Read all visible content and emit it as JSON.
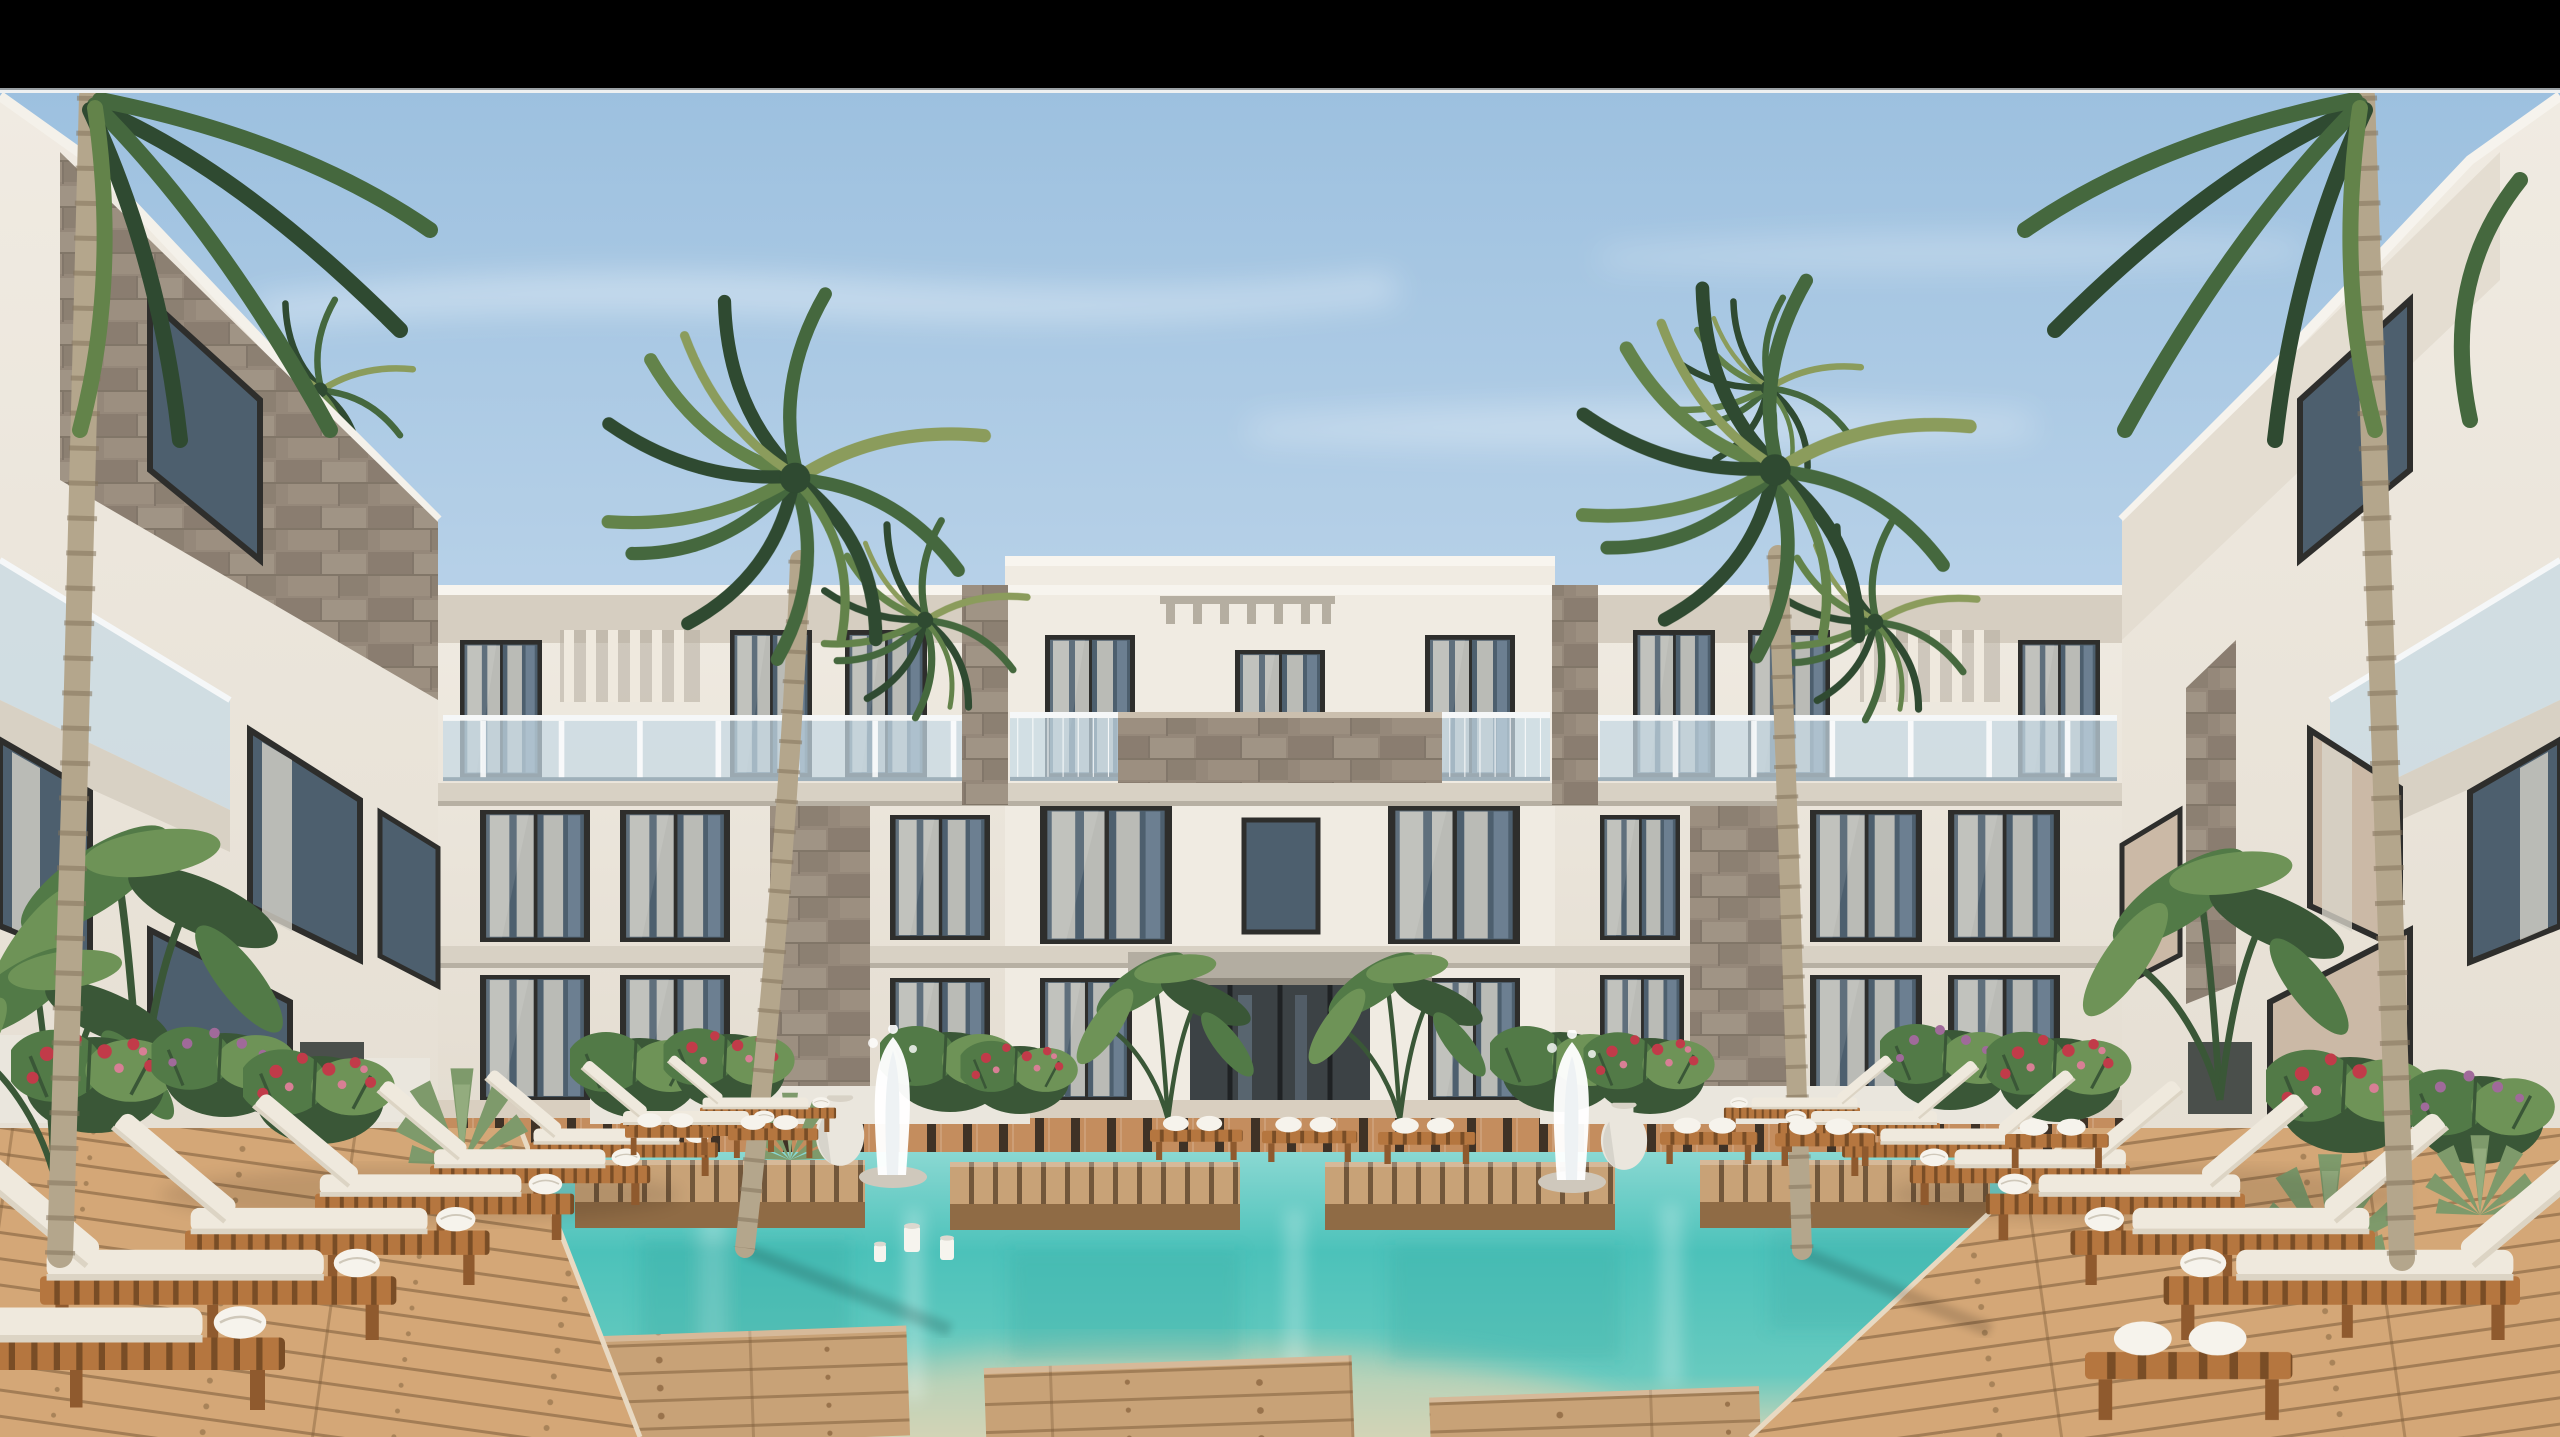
{
  "scene": {
    "kind": "architectural-render",
    "setting": "modern-resort-courtyard-with-pool",
    "letterbox": "black bar across top of frame",
    "buildings": {
      "center_building_floors": 3,
      "left_foreground_building": "stone-clad white wing",
      "right_foreground_building": "white wing with balconies",
      "features": [
        "glass balcony railings",
        "stone feature panels",
        "sheer curtains in windows",
        "entrance canopy",
        "pergola slats"
      ]
    },
    "vegetation": {
      "courtyard_palms": 2,
      "edge_palms": 2,
      "rooftop_palms": 4,
      "banana_plants": 4,
      "agaves": 4,
      "flower_bushes_red": 6,
      "flower_bushes_purple": 3
    },
    "poolside": {
      "double_sun_loungers_left": 6,
      "double_sun_loungers_right": 6,
      "far_deck_benches": 9,
      "stepping_platforms_in_water": 4,
      "foreground_wood_platforms": 3,
      "fountain_jets": 2,
      "urn_vases": 2,
      "pool_candles": 3
    }
  },
  "palette": {
    "letterbox": "#000000",
    "separator_dark": "#9aa0a4",
    "separator_light": "#eef0f1",
    "sky_top": "#9cc0df",
    "sky_mid": "#b7d1e8",
    "sky_low": "#cde0ee",
    "sky_horizon": "#dfe9f1",
    "cloud": "#ffffff",
    "wall_light": "#f0ebe2",
    "wall_mid": "#e4ddd1",
    "wall_shadow": "#cfc7b9",
    "wall_dark": "#b4ac9e",
    "slab_face": "#d8d1c4",
    "stone": "#95887a",
    "stone_dark": "#7c7063",
    "stone_light": "#ac9f8f",
    "window_frame": "#2e2e2c",
    "glass_dark": "#4d5f6e",
    "glass_mid": "#74879a",
    "glass_warm": "#cbb9a6",
    "curtain": "#d9d5cb",
    "railing_glass": "#c6d9e4",
    "canopy": "#b3ada1",
    "recess": "#3c4245",
    "wood_deck": "#c48d5e",
    "wood_deck_light": "#d4a777",
    "wood_slat_gap": "#3f3226",
    "wood_platform": "#c8a277",
    "wood_platform_side": "#8f6b45",
    "lounger_wood": "#b5763f",
    "lounger_wood_dark": "#8f5a2e",
    "cushion": "#efe9dd",
    "cushion_shade": "#dcd4c4",
    "towel": "#f6f3ec",
    "water_top": "#8ad8d2",
    "water_mid": "#4cc2ba",
    "water_low": "#67cabf",
    "water_sand": "#d3d4b6",
    "palm_dark": "#2f4a31",
    "palm_mid": "#45683e",
    "palm_light": "#63834a",
    "palm_accent": "#8b9c5c",
    "trunk": "#b4a68c",
    "trunk_ring": "#85755d",
    "green_dark": "#3a5737",
    "green_mid": "#527a47",
    "green_light": "#6e9357",
    "flower_red": "#c13b49",
    "flower_pink": "#d87f95",
    "flower_purple": "#a06a9a",
    "planter": "#eae6dd",
    "path_stone": "#d9cfc0"
  }
}
